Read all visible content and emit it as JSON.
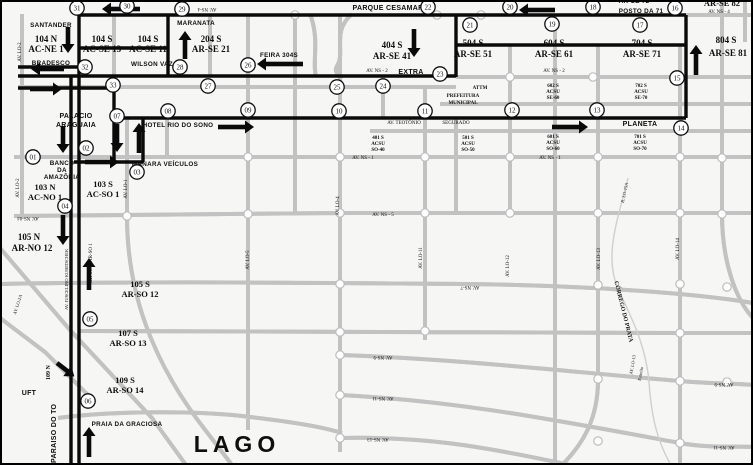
{
  "map": {
    "background": "#f6f6f4",
    "road_color": "#c2c2c2",
    "route_color": "#0a0a0a",
    "stop_fill": "#ffffff",
    "labels": [
      {
        "t": "SANTANDER",
        "x": 51,
        "y": 27,
        "c": "s6"
      },
      {
        "t": "104 N",
        "x": 46,
        "y": 42,
        "c": "q"
      },
      {
        "t": "AC-NE 1",
        "x": 46,
        "y": 52,
        "c": "q"
      },
      {
        "t": "BRADESCO",
        "x": 51,
        "y": 65,
        "c": "s6"
      },
      {
        "t": "104 S",
        "x": 102,
        "y": 42,
        "c": "q"
      },
      {
        "t": "AC-SE 13",
        "x": 102,
        "y": 52,
        "c": "q"
      },
      {
        "t": "104 S",
        "x": 148,
        "y": 42,
        "c": "q"
      },
      {
        "t": "AC-SE 11",
        "x": 148,
        "y": 52,
        "c": "q"
      },
      {
        "t": "WILSON VAZ",
        "x": 152,
        "y": 66,
        "c": "s6"
      },
      {
        "t": "MARANATA",
        "x": 196,
        "y": 25,
        "c": "s6"
      },
      {
        "t": "204 S",
        "x": 211,
        "y": 42,
        "c": "q"
      },
      {
        "t": "AR-SE 21",
        "x": 211,
        "y": 52,
        "c": "q"
      },
      {
        "t": "FEIRA 304S",
        "x": 279,
        "y": 57,
        "c": "s6"
      },
      {
        "t": "PARQUE CESAMAR",
        "x": 388,
        "y": 10,
        "c": "s7"
      },
      {
        "t": "404 S",
        "x": 392,
        "y": 48,
        "c": "q"
      },
      {
        "t": "AR-SE 41",
        "x": 392,
        "y": 59,
        "c": "q"
      },
      {
        "t": "AV. NS - 2",
        "x": 377,
        "y": 72,
        "c": "t"
      },
      {
        "t": "EXTRA",
        "x": 411,
        "y": 74,
        "c": "s7"
      },
      {
        "t": "504 S",
        "x": 473,
        "y": 46,
        "c": "q"
      },
      {
        "t": "AR-SE 51",
        "x": 473,
        "y": 57,
        "c": "q"
      },
      {
        "t": "604 S",
        "x": 554,
        "y": 46,
        "c": "q"
      },
      {
        "t": "AR-SE 61",
        "x": 554,
        "y": 57,
        "c": "q"
      },
      {
        "t": "704 S",
        "x": 642,
        "y": 46,
        "c": "q"
      },
      {
        "t": "AR-SE 71",
        "x": 642,
        "y": 57,
        "c": "q"
      },
      {
        "t": "804 S",
        "x": 726,
        "y": 43,
        "c": "q"
      },
      {
        "t": "AR-SE 81",
        "x": 728,
        "y": 56,
        "c": "q"
      },
      {
        "t": "AR-SE 72",
        "x": 634,
        "y": 3,
        "c": "s6"
      },
      {
        "t": "POSTO DA 71",
        "x": 641,
        "y": 13,
        "c": "s6"
      },
      {
        "t": "AR-SE 82",
        "x": 722,
        "y": 6,
        "c": "q8"
      },
      {
        "t": "AV. NS - 4",
        "x": 719,
        "y": 13,
        "c": "t"
      },
      {
        "t": "AV. NS-4",
        "x": 207,
        "y": 8,
        "c": "t",
        "r": 180
      },
      {
        "t": "AV. NS - 2",
        "x": 554,
        "y": 72,
        "c": "t"
      },
      {
        "t": "602 S",
        "x": 553,
        "y": 87,
        "c": "tb"
      },
      {
        "t": "ACSU",
        "x": 553,
        "y": 93,
        "c": "tb"
      },
      {
        "t": "SE-60",
        "x": 553,
        "y": 99,
        "c": "tb"
      },
      {
        "t": "702 S",
        "x": 641,
        "y": 87,
        "c": "tb"
      },
      {
        "t": "ACSU",
        "x": 641,
        "y": 93,
        "c": "tb"
      },
      {
        "t": "SE-70",
        "x": 641,
        "y": 99,
        "c": "tb"
      },
      {
        "t": "ATTM",
        "x": 480,
        "y": 89,
        "c": "tb"
      },
      {
        "t": "PREFEITURA",
        "x": 463,
        "y": 97,
        "c": "tb"
      },
      {
        "t": "MUNICIPAL",
        "x": 463,
        "y": 104,
        "c": "tb"
      },
      {
        "t": "HOTEL RIO DO SONO",
        "x": 178,
        "y": 127,
        "c": "s6"
      },
      {
        "t": "PALACIO",
        "x": 76,
        "y": 118,
        "c": "s7"
      },
      {
        "t": "ARAGUAIA",
        "x": 76,
        "y": 127,
        "c": "s7"
      },
      {
        "t": "BANCO",
        "x": 62,
        "y": 165,
        "c": "s6"
      },
      {
        "t": "DA",
        "x": 62,
        "y": 172,
        "c": "s6"
      },
      {
        "t": "AMAZÔNIA",
        "x": 62,
        "y": 179,
        "c": "s6"
      },
      {
        "t": "MANARA VEÍCULOS",
        "x": 165,
        "y": 166,
        "c": "s6"
      },
      {
        "t": "103 N",
        "x": 45,
        "y": 190,
        "c": "q8"
      },
      {
        "t": "AC-NO 1",
        "x": 45,
        "y": 200,
        "c": "q8"
      },
      {
        "t": "103 S",
        "x": 103,
        "y": 187,
        "c": "q8"
      },
      {
        "t": "AC-SO 1",
        "x": 103,
        "y": 197,
        "c": "q8"
      },
      {
        "t": "AV. LO-2",
        "x": 21,
        "y": 52,
        "c": "t",
        "r": -90
      },
      {
        "t": "AV. LO-2",
        "x": 19,
        "y": 188,
        "c": "t",
        "r": -90
      },
      {
        "t": "AV. LO-1",
        "x": 127,
        "y": 189,
        "c": "t",
        "r": -90
      },
      {
        "t": "AV. TEOTÔNIO",
        "x": 404,
        "y": 124,
        "c": "t"
      },
      {
        "t": "SEGURADO",
        "x": 456,
        "y": 124,
        "c": "t"
      },
      {
        "t": "401 S",
        "x": 378,
        "y": 139,
        "c": "tb"
      },
      {
        "t": "ACSU",
        "x": 378,
        "y": 145,
        "c": "tb"
      },
      {
        "t": "SO-40",
        "x": 378,
        "y": 151,
        "c": "tb"
      },
      {
        "t": "501 S",
        "x": 468,
        "y": 139,
        "c": "tb"
      },
      {
        "t": "ACSU",
        "x": 468,
        "y": 145,
        "c": "tb"
      },
      {
        "t": "SO-50",
        "x": 468,
        "y": 151,
        "c": "tb"
      },
      {
        "t": "601 S",
        "x": 553,
        "y": 138,
        "c": "tb"
      },
      {
        "t": "ACSU",
        "x": 553,
        "y": 144,
        "c": "tb"
      },
      {
        "t": "SO-60",
        "x": 553,
        "y": 150,
        "c": "tb"
      },
      {
        "t": "701 S",
        "x": 640,
        "y": 138,
        "c": "tb"
      },
      {
        "t": "ACSU",
        "x": 640,
        "y": 144,
        "c": "tb"
      },
      {
        "t": "SO-70",
        "x": 640,
        "y": 150,
        "c": "tb"
      },
      {
        "t": "AV. NS - 1",
        "x": 363,
        "y": 159,
        "c": "t"
      },
      {
        "t": "AV. NS - 1",
        "x": 550,
        "y": 159,
        "c": "t"
      },
      {
        "t": "PLANETA",
        "x": 640,
        "y": 126,
        "c": "s7"
      },
      {
        "t": "105 N",
        "x": 29,
        "y": 240,
        "c": "q"
      },
      {
        "t": "AR-NO 12",
        "x": 32,
        "y": 251,
        "c": "q"
      },
      {
        "t": "105 S",
        "x": 140,
        "y": 287,
        "c": "q8"
      },
      {
        "t": "AR-SO 12",
        "x": 140,
        "y": 297,
        "c": "q8"
      },
      {
        "t": "107 S",
        "x": 128,
        "y": 336,
        "c": "q8"
      },
      {
        "t": "AR-SO 13",
        "x": 128,
        "y": 346,
        "c": "q8"
      },
      {
        "t": "109 S",
        "x": 125,
        "y": 383,
        "c": "q8"
      },
      {
        "t": "AR-SO 14",
        "x": 125,
        "y": 393,
        "c": "q8"
      },
      {
        "t": "109 N",
        "x": 50,
        "y": 380,
        "c": "b6",
        "r": -90,
        "a": "s"
      },
      {
        "t": "UFT",
        "x": 29,
        "y": 395,
        "c": "s7"
      },
      {
        "t": "PRAIA DA GRACIOSA",
        "x": 127,
        "y": 426,
        "c": "s6"
      },
      {
        "t": "LAGO",
        "x": 237,
        "y": 452,
        "c": "big"
      },
      {
        "t": "PARAISO DO TO",
        "x": 56,
        "y": 463,
        "c": "s7",
        "r": -90,
        "a": "s"
      },
      {
        "t": "AV. JUSCELINO KUBITSCHEK",
        "x": 68,
        "y": 310,
        "c": "t45",
        "r": -90,
        "a": "s"
      },
      {
        "t": "AR-SO12  AR-SO 1",
        "x": 92,
        "y": 283,
        "c": "t",
        "r": -90,
        "a": "s"
      },
      {
        "t": "AV. NS-04",
        "x": 28,
        "y": 217,
        "c": "t",
        "r": 180
      },
      {
        "t": "AV. NS - 5",
        "x": 383,
        "y": 216,
        "c": "t"
      },
      {
        "t": "AV. LO-4",
        "x": 339,
        "y": 206,
        "c": "t",
        "r": -90
      },
      {
        "t": "AV. LO-5",
        "x": 249,
        "y": 260,
        "c": "t",
        "r": -90
      },
      {
        "t": "AV. LO-11",
        "x": 422,
        "y": 258,
        "c": "t",
        "r": -90
      },
      {
        "t": "AV. LO-12",
        "x": 509,
        "y": 266,
        "c": "t",
        "r": -90
      },
      {
        "t": "AV. LO-13",
        "x": 600,
        "y": 259,
        "c": "t",
        "r": -90
      },
      {
        "t": "AV. LO-14",
        "x": 679,
        "y": 249,
        "c": "t",
        "r": -90
      },
      {
        "t": "R. LO-15A",
        "x": 626,
        "y": 193,
        "c": "t45",
        "r": -78
      },
      {
        "t": "CÓRREGO DO PRATA",
        "x": 622,
        "y": 312,
        "c": "cor",
        "r": 76
      },
      {
        "t": "AV. LO-13",
        "x": 634,
        "y": 365,
        "c": "t45",
        "r": -80
      },
      {
        "t": "Estreito",
        "x": 642,
        "y": 374,
        "c": "t45",
        "r": -80
      },
      {
        "t": "AV. NS-7",
        "x": 470,
        "y": 286,
        "c": "t",
        "r": 180
      },
      {
        "t": "AV. NS-9",
        "x": 383,
        "y": 356,
        "c": "t",
        "r": 180
      },
      {
        "t": "AV. NS-9",
        "x": 724,
        "y": 383,
        "c": "t",
        "r": 180
      },
      {
        "t": "AV. NS-11",
        "x": 383,
        "y": 397,
        "c": "t",
        "r": 180
      },
      {
        "t": "AV. NS-11",
        "x": 724,
        "y": 446,
        "c": "t",
        "r": 180
      },
      {
        "t": "AV. NS-13",
        "x": 378,
        "y": 438,
        "c": "t",
        "r": 180
      },
      {
        "t": "AV. LO-2A",
        "x": 19,
        "y": 305,
        "c": "t45",
        "r": -72
      }
    ],
    "stops": [
      {
        "n": "01",
        "x": 33,
        "y": 157
      },
      {
        "n": "02",
        "x": 86,
        "y": 148
      },
      {
        "n": "03",
        "x": 137,
        "y": 172
      },
      {
        "n": "04",
        "x": 65,
        "y": 206
      },
      {
        "n": "05",
        "x": 90,
        "y": 319
      },
      {
        "n": "06",
        "x": 88,
        "y": 401
      },
      {
        "n": "07",
        "x": 117,
        "y": 116
      },
      {
        "n": "08",
        "x": 168,
        "y": 111
      },
      {
        "n": "09",
        "x": 248,
        "y": 110
      },
      {
        "n": "10",
        "x": 339,
        "y": 111
      },
      {
        "n": "11",
        "x": 425,
        "y": 111
      },
      {
        "n": "12",
        "x": 512,
        "y": 110
      },
      {
        "n": "13",
        "x": 597,
        "y": 110
      },
      {
        "n": "14",
        "x": 681,
        "y": 128
      },
      {
        "n": "15",
        "x": 677,
        "y": 78
      },
      {
        "n": "16",
        "x": 675,
        "y": 8
      },
      {
        "n": "17",
        "x": 640,
        "y": 25
      },
      {
        "n": "18",
        "x": 593,
        "y": 7
      },
      {
        "n": "19",
        "x": 552,
        "y": 24
      },
      {
        "n": "20",
        "x": 510,
        "y": 7
      },
      {
        "n": "21",
        "x": 470,
        "y": 25
      },
      {
        "n": "22",
        "x": 428,
        "y": 7
      },
      {
        "n": "23",
        "x": 440,
        "y": 74
      },
      {
        "n": "24",
        "x": 383,
        "y": 86
      },
      {
        "n": "25",
        "x": 337,
        "y": 87
      },
      {
        "n": "26",
        "x": 248,
        "y": 65
      },
      {
        "n": "27",
        "x": 208,
        "y": 86
      },
      {
        "n": "28",
        "x": 180,
        "y": 67
      },
      {
        "n": "29",
        "x": 182,
        "y": 9
      },
      {
        "n": "30",
        "x": 127,
        "y": 6
      },
      {
        "n": "31",
        "x": 77,
        "y": 8
      },
      {
        "n": "32",
        "x": 85,
        "y": 67
      },
      {
        "n": "33",
        "x": 113,
        "y": 85
      }
    ],
    "route_segments": [
      [
        686,
        15,
        78,
        15
      ],
      [
        686,
        15,
        686,
        118
      ],
      [
        686,
        118,
        113,
        118
      ],
      [
        168,
        15,
        168,
        77
      ],
      [
        79,
        48,
        168,
        48
      ],
      [
        456,
        15,
        456,
        77
      ],
      [
        456,
        76,
        18,
        76
      ],
      [
        18,
        67,
        79,
        67
      ],
      [
        18,
        88,
        114,
        88
      ],
      [
        114,
        88,
        114,
        162
      ],
      [
        74,
        162,
        143,
        162
      ],
      [
        143,
        118,
        143,
        162
      ],
      [
        456,
        45,
        686,
        45
      ],
      [
        79,
        14,
        79,
        465
      ],
      [
        71,
        76,
        71,
        465
      ]
    ],
    "arrows": [
      {
        "x": 555,
        "y": 10,
        "a": 180,
        "l": 36
      },
      {
        "x": 140,
        "y": 9,
        "a": 180,
        "l": 38
      },
      {
        "x": 68,
        "y": 27,
        "a": 90,
        "l": 26
      },
      {
        "x": 64,
        "y": 69,
        "a": 180,
        "l": 33
      },
      {
        "x": 30,
        "y": 89,
        "a": 0,
        "l": 32
      },
      {
        "x": 414,
        "y": 29,
        "a": 90,
        "l": 28
      },
      {
        "x": 185,
        "y": 59,
        "a": -90,
        "l": 28
      },
      {
        "x": 303,
        "y": 64,
        "a": 180,
        "l": 46
      },
      {
        "x": 117,
        "y": 124,
        "a": 90,
        "l": 28
      },
      {
        "x": 139,
        "y": 153,
        "a": -90,
        "l": 30
      },
      {
        "x": 85,
        "y": 162,
        "a": 0,
        "l": 34
      },
      {
        "x": 218,
        "y": 127,
        "a": 0,
        "l": 36
      },
      {
        "x": 552,
        "y": 127,
        "a": 0,
        "l": 36
      },
      {
        "x": 63,
        "y": 126,
        "a": 90,
        "l": 27
      },
      {
        "x": 63,
        "y": 215,
        "a": 90,
        "l": 30
      },
      {
        "x": 89,
        "y": 290,
        "a": -90,
        "l": 32
      },
      {
        "x": 89,
        "y": 457,
        "a": -90,
        "l": 30
      },
      {
        "x": 696,
        "y": 75,
        "a": -90,
        "l": 30
      },
      {
        "x": 57,
        "y": 363,
        "a": 38,
        "l": 22
      }
    ],
    "junctions": [
      [
        248,
        157
      ],
      [
        340,
        157
      ],
      [
        425,
        157
      ],
      [
        510,
        157
      ],
      [
        598,
        157
      ],
      [
        680,
        157
      ],
      [
        722,
        158
      ],
      [
        127,
        216
      ],
      [
        248,
        214
      ],
      [
        340,
        213
      ],
      [
        425,
        213
      ],
      [
        510,
        213
      ],
      [
        598,
        213
      ],
      [
        680,
        213
      ],
      [
        722,
        214
      ],
      [
        340,
        284
      ],
      [
        598,
        285
      ],
      [
        680,
        284
      ],
      [
        727,
        287
      ],
      [
        340,
        332
      ],
      [
        425,
        331
      ],
      [
        680,
        333
      ],
      [
        340,
        355
      ],
      [
        598,
        379
      ],
      [
        680,
        381
      ],
      [
        727,
        382
      ],
      [
        340,
        395
      ],
      [
        598,
        441
      ],
      [
        680,
        443
      ],
      [
        340,
        438
      ],
      [
        295,
        15
      ],
      [
        437,
        15
      ],
      [
        481,
        15
      ],
      [
        510,
        77
      ],
      [
        593,
        77
      ]
    ]
  }
}
